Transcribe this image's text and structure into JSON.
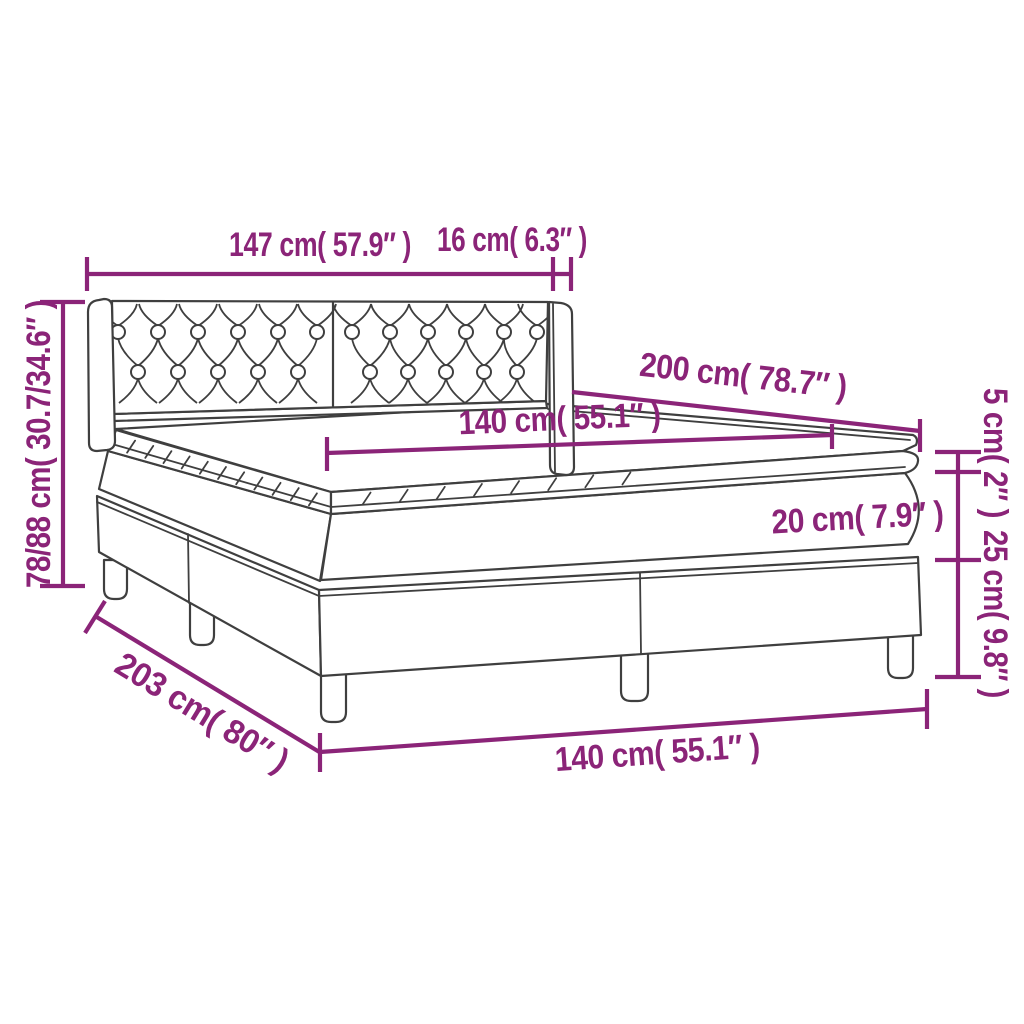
{
  "figure": {
    "type": "product-dimension-diagram",
    "subject": "box spring bed with tufted headboard, mattress and topper",
    "background_color": "#ffffff",
    "accent_color": "#8b2478",
    "outline_color": "#3f3f3f",
    "labels": {
      "headboard_width": "147 cm( 57.9″ )",
      "headboard_depth": "16 cm( 6.3″ )",
      "total_height": "78/88 cm( 30.7/34.6″ )",
      "bed_length_top": "200 cm( 78.7″ )",
      "mattress_width_top": "140 cm( 55.1″ )",
      "topper_height": "5 cm( 2″ )",
      "mattress_height": "20 cm( 7.9″ )",
      "base_height": "25 cm( 9.8″ )",
      "base_length": "203 cm( 80″ )",
      "base_width_bottom": "140 cm( 55.1″ )"
    }
  }
}
